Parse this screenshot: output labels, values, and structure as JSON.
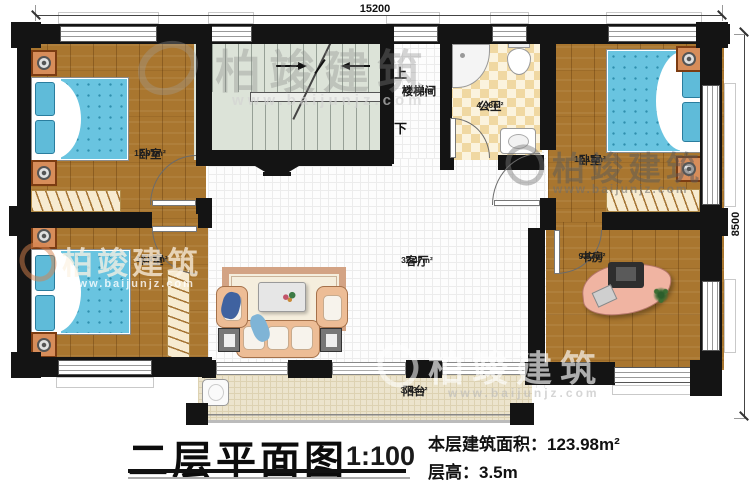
{
  "meta": {
    "title": "二层平面图",
    "scale": "1:100",
    "area_label": "本层建筑面积：",
    "area_value": "123.98m²",
    "height_label": "层高：",
    "height_value": "3.5m"
  },
  "dimensions": {
    "top": "15200",
    "right": "8500"
  },
  "stairs": {
    "up": "上",
    "down": "下"
  },
  "rooms": [
    {
      "id": "bedroom-1",
      "name": "卧室",
      "area": "12.91m²"
    },
    {
      "id": "stairwell",
      "name": "楼梯间",
      "area": "12.84m²"
    },
    {
      "id": "bathroom",
      "name": "公卫",
      "area": "4.98m²"
    },
    {
      "id": "bedroom-2",
      "name": "卧室",
      "area": "12.18m²"
    },
    {
      "id": "bedroom-3",
      "name": "卧室",
      "area": "10.47m²"
    },
    {
      "id": "living-room",
      "name": "客厅",
      "area": "32.47m²"
    },
    {
      "id": "study",
      "name": "书房",
      "area": "9.87m²"
    },
    {
      "id": "balcony",
      "name": "阳台",
      "area": "3.43m²"
    }
  ],
  "watermark": {
    "brand": "柏竣建筑",
    "url": "www.baijunjz.com"
  },
  "colors": {
    "wall": "#141414",
    "wood_floor": "#a9762f",
    "mattress_blue": "#69c4e0",
    "bathroom_tile": "#f0d8a2",
    "stair_floor": "#dce3d8",
    "balcony_floor": "#ece4cd",
    "nightstand_orange": "#d78d5a",
    "sofa_tan": "#edbd96",
    "desk_salmon": "#f0b4a2"
  }
}
